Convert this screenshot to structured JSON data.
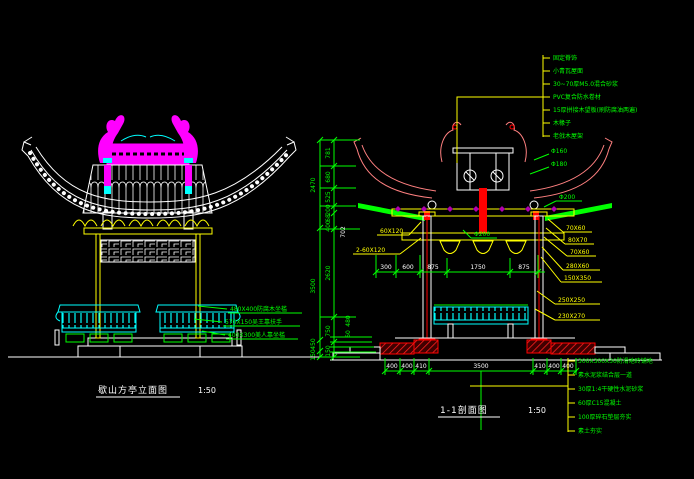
{
  "drawing": {
    "background": "#000000",
    "palette": {
      "white": "#ffffff",
      "green": "#00ff00",
      "yellow": "#ffff00",
      "cyan": "#00ffff",
      "magenta": "#ff00ff",
      "red": "#ff0000",
      "roof_pink": "#ff8080"
    }
  },
  "elevation": {
    "title": "歇山方亭立面图",
    "scale": "1:50",
    "notes": [
      "480X400防腐木坐槛",
      "570X150吴王靠扶手",
      "400X300美人靠坐槛"
    ]
  },
  "section": {
    "title": "1-1剖面图",
    "scale": "1:50",
    "roof_notes": [
      "固定脊饰",
      "小青瓦屋面",
      "30~70厚M5.0混合砂浆",
      "PVC复合防水卷材",
      "15厚拼接木望板(刷防腐油两遍)",
      "木椽子",
      "老戗木屋架"
    ],
    "floor_notes": [
      "300X300X30防滑地砖铺地",
      "素水泥浆结合层一道",
      "30厚1:4干硬性水泥砂浆",
      "60厚C15混凝土",
      "100厚碎石垫层夯实",
      "素土夯实"
    ],
    "member_labels": {
      "rafter_batten": "60X120",
      "double_batten": "2-60X120",
      "purlin_a": "70X60",
      "purlin_b": "80X70",
      "purlin_c": "70X60",
      "fascia": "280X60",
      "beam_a": "150X350",
      "beam_b": "250X250",
      "beam_c": "230X270"
    },
    "diameter_labels": {
      "d1": "Φ160",
      "d2": "Φ180",
      "d3": "Φ200",
      "d4": "Φ200"
    },
    "dims": {
      "left_outer": [
        "2470",
        "3500",
        "450",
        "150"
      ],
      "left_inner": [
        "781",
        "680",
        "525",
        "200",
        "68",
        "400",
        "2620",
        "750",
        "150"
      ],
      "left_extra": [
        "702",
        "480",
        "60"
      ],
      "top_row": [
        "300",
        "600",
        "875",
        "1750",
        "875"
      ],
      "bottom_row": [
        "400",
        "400",
        "410",
        "3500",
        "410",
        "400",
        "400"
      ]
    }
  }
}
